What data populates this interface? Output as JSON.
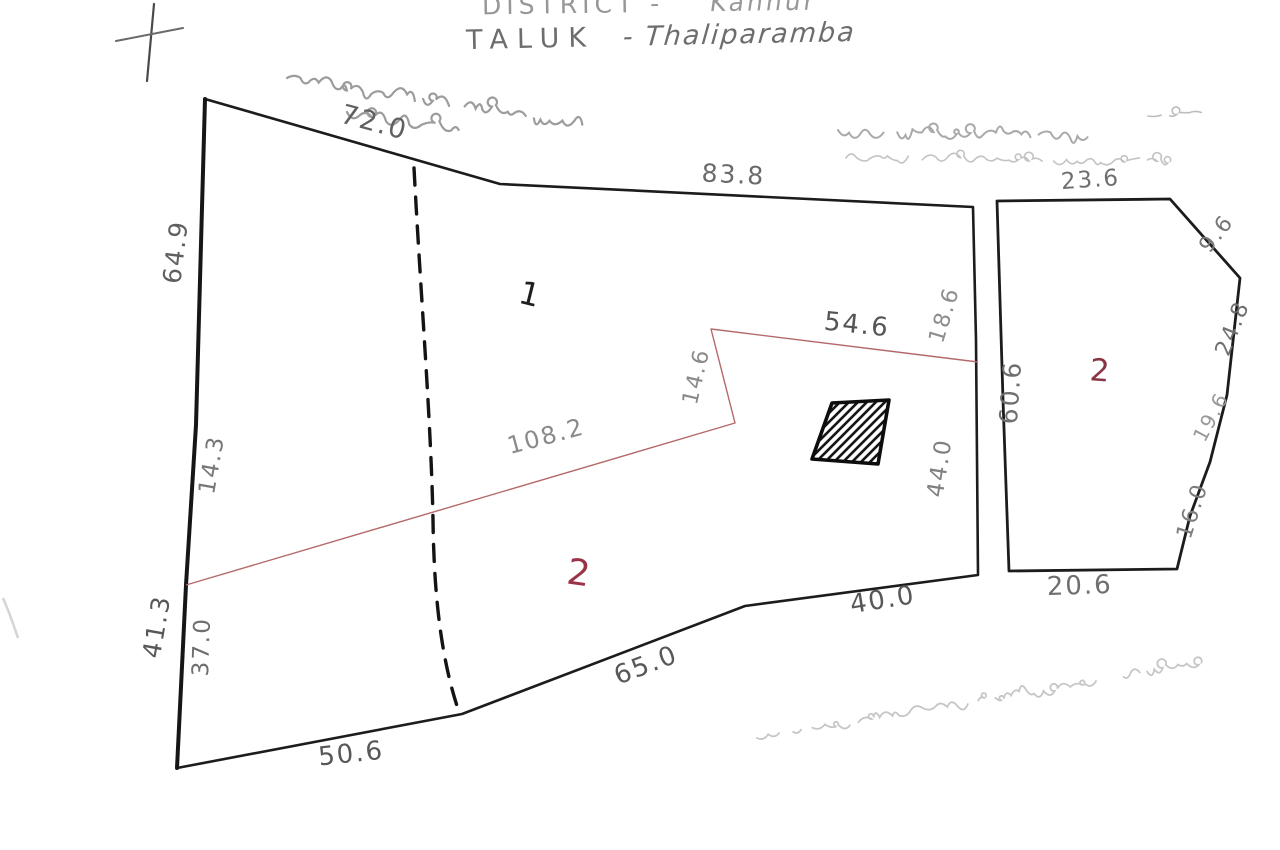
{
  "page": {
    "width": 1280,
    "height": 850,
    "background": "#ffffff",
    "description": "Scanned hand-drawn cadastral survey sketch of two land parcels"
  },
  "header": {
    "district_label": "DISTRICT -",
    "district_value": "Kannur",
    "taluk_label": "TALUK",
    "taluk_value": "- Thaliparamba"
  },
  "colors": {
    "ink": "#1c1c1c",
    "pencil": "#6e6e6e",
    "pencil_light": "#8f8f8f",
    "red_line": "#b56a6a",
    "red_text": "#99344a",
    "faint": "#c5c5c5"
  },
  "parcels": [
    {
      "id": "left-parcel",
      "boundary_lengths": [
        "72.0",
        "83.8",
        "18.6",
        "44.0",
        "40.0",
        "65.0",
        "50.6",
        "41.3",
        "37.0",
        "14.3",
        "64.9"
      ],
      "subdivision_lengths": [
        "108.2",
        "14.6",
        "54.6"
      ],
      "plot_numbers": [
        "1",
        "2"
      ],
      "features": [
        "hatched-building",
        "dashed-path"
      ]
    },
    {
      "id": "right-parcel",
      "boundary_lengths": [
        "23.6",
        "9.6",
        "24.8",
        "19.6",
        "16.0",
        "20.6",
        "60.6"
      ],
      "plot_numbers": [
        "2"
      ]
    }
  ],
  "measurements": [
    {
      "id": "72-0",
      "value": "72.0",
      "x": 372,
      "y": 131,
      "rot": 15,
      "fs": 27,
      "color": "#606060"
    },
    {
      "id": "83-8",
      "value": "83.8",
      "x": 733,
      "y": 183,
      "rot": 3,
      "fs": 25,
      "color": "#6a6a6a"
    },
    {
      "id": "64-9",
      "value": "64.9",
      "x": 184,
      "y": 253,
      "rot": -83,
      "fs": 25,
      "color": "#5f5f5f"
    },
    {
      "id": "14-3",
      "value": "14.3",
      "x": 219,
      "y": 466,
      "rot": -80,
      "fs": 23,
      "color": "#777777"
    },
    {
      "id": "41-3",
      "value": "41.3",
      "x": 165,
      "y": 628,
      "rot": -80,
      "fs": 25,
      "color": "#585858"
    },
    {
      "id": "37-0",
      "value": "37.0",
      "x": 209,
      "y": 647,
      "rot": -88,
      "fs": 23,
      "color": "#6f6f6f"
    },
    {
      "id": "50-6",
      "value": "50.6",
      "x": 352,
      "y": 762,
      "rot": -6,
      "fs": 26,
      "color": "#585858"
    },
    {
      "id": "65-0",
      "value": "65.0",
      "x": 649,
      "y": 673,
      "rot": -21,
      "fs": 26,
      "color": "#585858"
    },
    {
      "id": "40-0",
      "value": "40.0",
      "x": 884,
      "y": 608,
      "rot": -9,
      "fs": 26,
      "color": "#585858"
    },
    {
      "id": "18-6",
      "value": "18.6",
      "x": 951,
      "y": 317,
      "rot": -73,
      "fs": 22,
      "color": "#8d8d8d"
    },
    {
      "id": "44-0",
      "value": "44.0",
      "x": 947,
      "y": 469,
      "rot": -81,
      "fs": 23,
      "color": "#808080"
    },
    {
      "id": "54-6",
      "value": "54.6",
      "x": 856,
      "y": 333,
      "rot": 6,
      "fs": 26,
      "color": "#555555"
    },
    {
      "id": "14-6",
      "value": "14.6",
      "x": 703,
      "y": 378,
      "rot": -77,
      "fs": 22,
      "color": "#8a8a8a"
    },
    {
      "id": "108-2",
      "value": "108.2",
      "x": 548,
      "y": 444,
      "rot": -15,
      "fs": 24,
      "color": "#8a8a8a"
    },
    {
      "id": "23-6",
      "value": "23.6",
      "x": 1091,
      "y": 187,
      "rot": -4,
      "fs": 23,
      "color": "#6f6f6f"
    },
    {
      "id": "9-6",
      "value": "9.6",
      "x": 1222,
      "y": 238,
      "rot": -52,
      "fs": 22,
      "color": "#777777"
    },
    {
      "id": "24-8",
      "value": "24.8",
      "x": 1239,
      "y": 331,
      "rot": -68,
      "fs": 22,
      "color": "#6f6f6f"
    },
    {
      "id": "19-6",
      "value": "19.6",
      "x": 1217,
      "y": 420,
      "rot": -62,
      "fs": 20,
      "color": "#999999"
    },
    {
      "id": "16-0",
      "value": "16.0",
      "x": 1199,
      "y": 513,
      "rot": -72,
      "fs": 22,
      "color": "#7d7d7d"
    },
    {
      "id": "20-6",
      "value": "20.6",
      "x": 1080,
      "y": 594,
      "rot": -2,
      "fs": 26,
      "color": "#6f6f6f"
    },
    {
      "id": "60-6",
      "value": "60.6",
      "x": 1019,
      "y": 393,
      "rot": -86,
      "fs": 25,
      "color": "#6f6f6f"
    }
  ],
  "plot_numbers": [
    {
      "id": "plot-1-left-parcel",
      "value": "1",
      "x": 528,
      "y": 305,
      "rot": 14,
      "fs": 32,
      "color": "#1e1e1e"
    },
    {
      "id": "plot-2-left-parcel",
      "value": "2",
      "x": 578,
      "y": 585,
      "rot": 8,
      "fs": 36,
      "color": "#993349"
    },
    {
      "id": "plot-2-right-parcel",
      "value": "2",
      "x": 1100,
      "y": 381,
      "rot": 4,
      "fs": 31,
      "color": "#8a3545"
    }
  ],
  "annotations_note": "Faint Malayalam cursive handwriting, not legible in the scan",
  "annotations": [
    {
      "id": "malayalam-top-left-line1",
      "script": "Malayalam",
      "legible": false,
      "x": 287,
      "y": 78,
      "len": 300,
      "angle": 9,
      "amp": 9,
      "sw": 2.2,
      "color": "#9c9c9c",
      "seed": 11
    },
    {
      "id": "malayalam-top-left-line2",
      "script": "Malayalam",
      "legible": false,
      "x": 347,
      "y": 112,
      "len": 110,
      "angle": 9,
      "amp": 9,
      "sw": 2.2,
      "color": "#9c9c9c",
      "seed": 23
    },
    {
      "id": "malayalam-top-right-line1",
      "script": "Malayalam",
      "legible": false,
      "x": 838,
      "y": 130,
      "len": 250,
      "angle": 1.5,
      "amp": 8,
      "sw": 2,
      "color": "#a9a9a9",
      "seed": 37
    },
    {
      "id": "malayalam-top-right-line2",
      "script": "Malayalam",
      "legible": false,
      "x": 846,
      "y": 158,
      "len": 318,
      "angle": 0.5,
      "amp": 6,
      "sw": 1.6,
      "color": "#c3c3c3",
      "seed": 51
    },
    {
      "id": "malayalam-bottom-right",
      "script": "Malayalam",
      "legible": false,
      "x": 757,
      "y": 738,
      "len": 450,
      "angle": -9.5,
      "amp": 7,
      "sw": 1.8,
      "color": "#c6c6c6",
      "seed": 67
    },
    {
      "id": "stray-dash-top-right",
      "script": "mark",
      "legible": false,
      "x": 1148,
      "y": 116,
      "len": 46,
      "angle": -4,
      "amp": 1.5,
      "sw": 1.6,
      "color": "#bdbdbd",
      "seed": 5
    }
  ]
}
